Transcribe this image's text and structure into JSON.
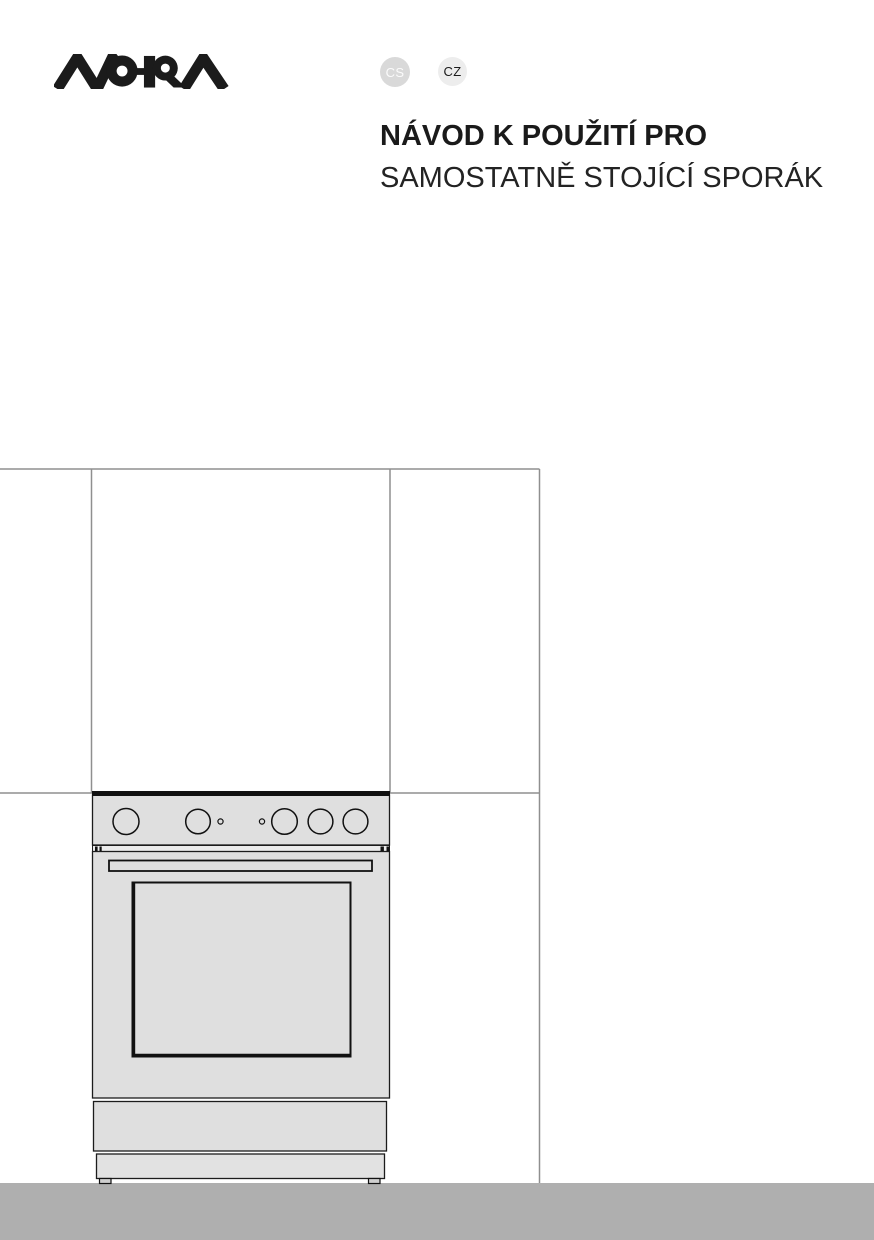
{
  "brand": {
    "name": "MORA"
  },
  "language_badges": [
    {
      "code": "CS"
    },
    {
      "code": "CZ"
    }
  ],
  "title": {
    "line1": "NÁVOD K POUŽITÍ PRO",
    "line2": "SAMOSTATNĚ STOJÍCÍ SPORÁK"
  },
  "illustration": {
    "subject": "line drawing of a freestanding cooker built into kitchen cabinetry",
    "large_knobs": 5,
    "indicator_lights": 2
  },
  "colors": {
    "logo": "#1b1b1b",
    "badge_cs_bg": "#d9d9d9",
    "badge_cs_text": "#fbfbfb",
    "badge_cz_bg": "#ededed",
    "badge_cz_text": "#1b1b1b",
    "title_text": "#1a1a1a",
    "cabinet_line": "#8f8f8f",
    "appliance_fill": "#dfdfdf",
    "appliance_outline": "#1c1c1c",
    "floor": "#afafaf",
    "page_bg": "#ffffff"
  }
}
